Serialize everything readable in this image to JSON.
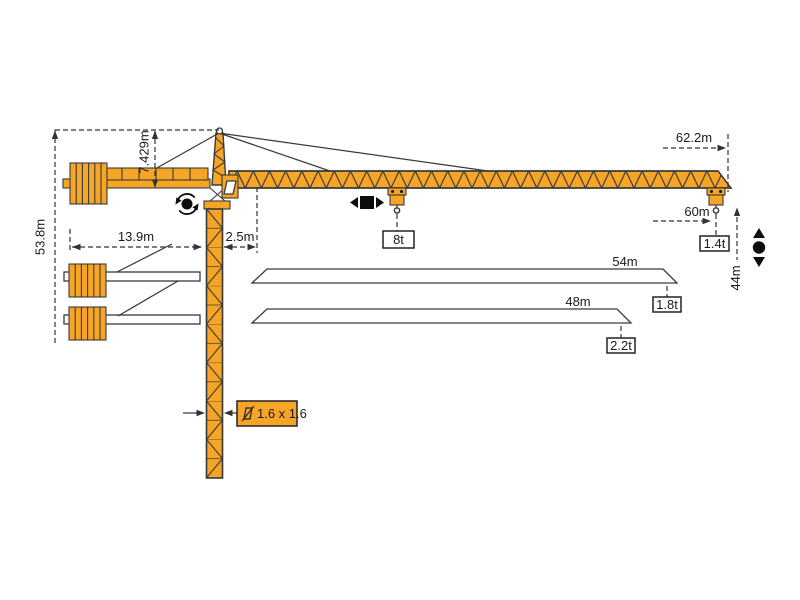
{
  "dimensions": {
    "total_height": "53.8m",
    "tower_head_height": "7.429m",
    "counter_jib_radius": "13.9m",
    "jib_root_offset": "2.5m",
    "max_jib_radius": "62.2m",
    "tip_hook_radius": "60m",
    "under_hook_height": "44m",
    "mast_cross_section": "1.6 x 1.6"
  },
  "capacities": {
    "max_trolley_load": "8t",
    "tip_load_62m": "1.4t",
    "tip_load_54m": "1.8t",
    "tip_load_48m": "2.2t"
  },
  "jib_variants": {
    "variant_54": "54m",
    "variant_48": "48m"
  },
  "icons": {
    "slewing": "slewing-rotation-icon",
    "trolley": "trolley-travel-icon",
    "hoist": "hoist-up-down-icon",
    "cross_section": "mast-cross-section-icon"
  },
  "colors": {
    "crane_orange": "#F6A527",
    "outline_dark": "#3A3A3A",
    "dim_line": "#333333",
    "icon_black": "#0D0D0D",
    "background": "#FFFFFF"
  }
}
